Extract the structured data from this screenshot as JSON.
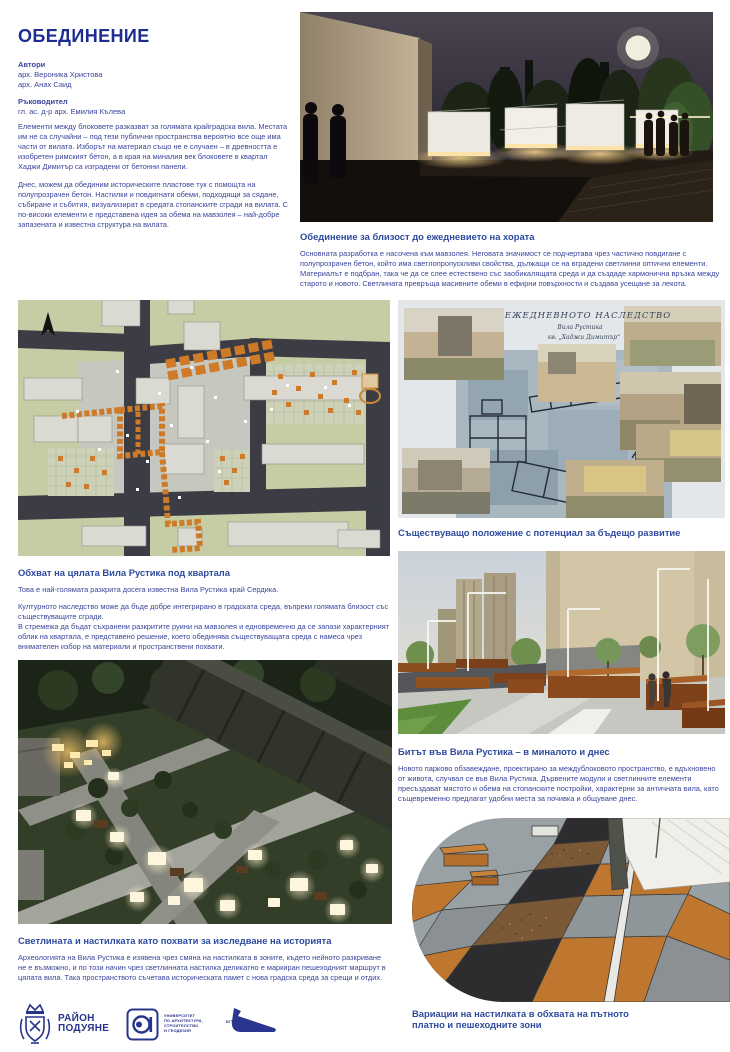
{
  "page": {
    "title": "ОБЕДИНЕНИЕ",
    "accent_color": "#1d2d91",
    "body_color": "#3a459c"
  },
  "header": {
    "authors_label": "Автори",
    "authors": [
      "арх. Вероника Христова",
      "арх. Анах Саид"
    ],
    "supervisor_label": "Ръководител",
    "supervisor": "гл. ас. д-р арх. Емилия Кълева",
    "intro_p1": "Елементи между блоковете разказват за голямата крайградска вила. Местата им не са случайни – под тези публични пространства вероятно все още има части от вилата. Изборът на материал също не е случаен – в древността е изобретен римският бетон, а в края на миналия век блоковете в квартал Хаджи Димитър са изградени от бетонни панели.",
    "intro_p2": "Днес, можем да обединим историческите пластове тук с помощта на полупрозрачен бетон. Настилки и повдигнати обеми, подходящи за сядане, събиране и събития, визуализират в средата стопанските сгради на вилата. С по-високи елементи е представена идея за обема на мавзолея – най-добре запазената и известна структура на вилата."
  },
  "sections": {
    "unification": {
      "heading": "Обединение за близост до ежедневието на хората",
      "body": "Основната разработка е насочена към мавзолея. Неговата значимост се подчертава чрез частично повдигане с полупрозрачен бетон, който има светлопропускливи свойства, дължащи се на вградени светлинни оптични елементи. Материалът е подбран, така че да се слее естествено със заобикалящата среда и да създаде хармонична връзка между старото и новото. Светлината превръща масивните обеми в ефирни повърхности и създава усещане за лекота."
    },
    "existing": {
      "caption": "Съществуващо положение с потенциал за бъдещо развитие"
    },
    "scope": {
      "heading": "Обхват на цялата Вила Рустика под квартала",
      "body1": "Това е най-голямата разкрита досега известна Вила Рустика край Сердика.",
      "body2": "Културното наследство може да бъде добре интегрирано в градската среда, въпреки голямата близост със съществуващите сгради.",
      "body3": "В стремежа да бъдат съхранени разкритите руини на мавзолея и едновременно да се запази характерният облик на квартала, е представено решение, което обединява съществуващата среда с намеса чрез внимателен избор на материали и пространствени похвати."
    },
    "life": {
      "heading": "Битът във Вила Рустика – в миналото и днес",
      "body": "Новото парково обзавеждане, проектирано за междублоковото пространство, е вдъхновено от живота, случвал се във Вила Рустика. Дървените модули и светлинните елементи пресъздават мястото и обема на стопанските постройки, характерни за античната вила, като същевременно предлагат удобни места за почивка и общуване днес."
    },
    "light": {
      "heading": "Светлината и настилката като похвати за изследване на историята",
      "body": "Археологията на Вила Рустика е изявена чрез смяна на настилката в зоните, където нейното разкриване не е възможно, и по този начин чрез светлинната настилка деликатно е маркиран пешеходният маршрут в цялата вила. Така пространството съчетава историческата памет с нова градска среда за срещи и отдих."
    },
    "paving": {
      "caption": "Вариации на настилката в обхвата на пътното платно и пешеходните зони"
    }
  },
  "collage": {
    "title_line1": "ЕЖЕДНЕВНОТО НАСЛЕДСТВО",
    "title_line2": "Вила Рустика",
    "title_line3": "кв. „Хаджи Димитър“"
  },
  "footer": {
    "district_logo": {
      "line1": "РАЙОН",
      "line2": "ПОДУЯНЕ"
    },
    "university_logo": {
      "line1": "УНИВЕРСИТЕТ",
      "line2": "ПО АРХИТЕКТУРА,",
      "line3": "СТРОИТЕЛСТВО",
      "line4": "И ГЕОДЕЗИЯ"
    },
    "partner_logo": {
      "label": "БГТА"
    }
  }
}
